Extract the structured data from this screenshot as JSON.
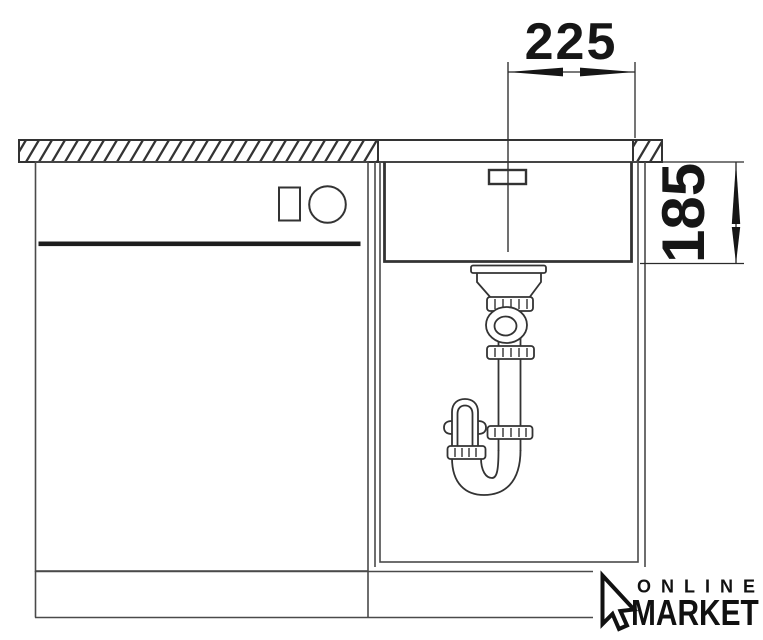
{
  "drawing": {
    "dimension_width": "225",
    "dimension_depth": "185",
    "colors": {
      "background": "#ffffff",
      "outline_dark": "#333333",
      "cabinet_line": "#4a4a4a",
      "ink": "#161616"
    }
  },
  "logo": {
    "icon": "mouse-cursor",
    "line1": "ONLINE",
    "line2": "MARKET"
  }
}
